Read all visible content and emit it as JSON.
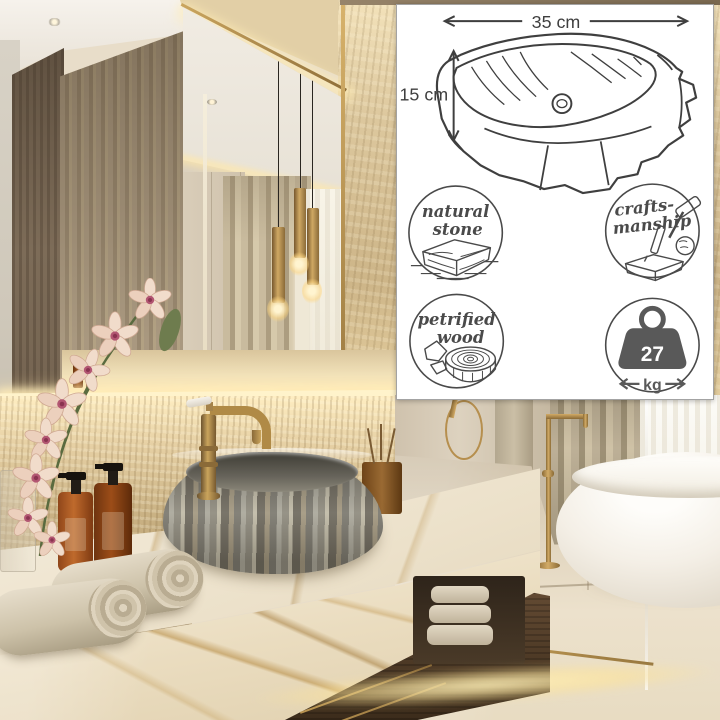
{
  "product_panel": {
    "dimensions": {
      "width": "35 cm",
      "height": "15 cm"
    },
    "badges": {
      "natural_stone": {
        "line1": "natural",
        "line2": "stone"
      },
      "craftsmanship": {
        "line1": "crafts-",
        "line2": "manship"
      },
      "petrified_wood": {
        "line1": "petrified",
        "line2": "wood"
      },
      "weight": {
        "value": "27",
        "unit": "kg"
      }
    },
    "icons": {
      "width_arrow": "double-headed-horizontal-arrow",
      "height_arrow": "double-headed-vertical-arrow",
      "natural_stone": "stone-block",
      "craftsmanship": "hammer-and-chisel-on-stone",
      "petrified_wood": "log-cross-section-with-rocks",
      "weight": "kettlebell-weight-with-arrows"
    },
    "colors": {
      "panel_background": "#ffffff",
      "panel_border": "#a3a3a3",
      "line_art": "#3f3f3f",
      "weight_fill": "#595959"
    }
  },
  "scene": {
    "alt": "Luxury beige bathroom: petrified-wood vessel sink with antique brass faucet on gold-veined marble vanity, rolled towels, amber soap bottles, orchid, gold pendant lights reflected in mirror, freestanding white bathtub with gold floor-mounted filler"
  }
}
